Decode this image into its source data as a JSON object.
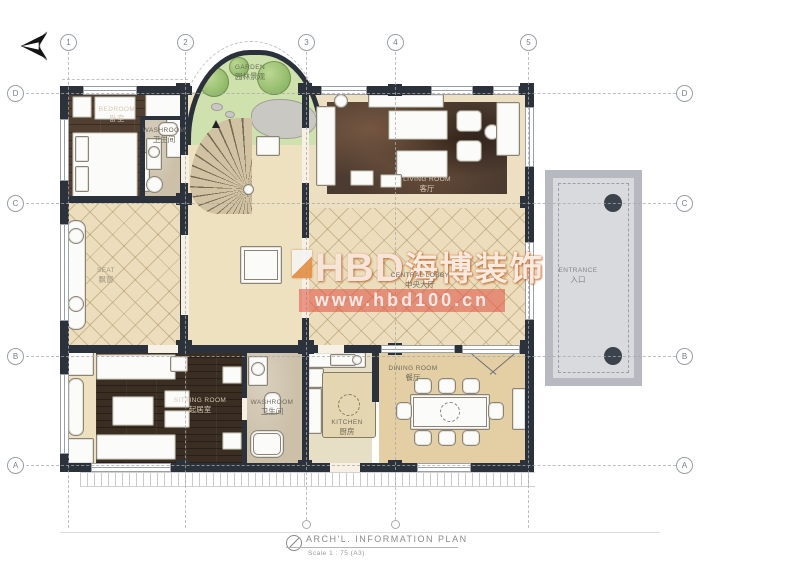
{
  "grid": {
    "columns": [
      "1",
      "2",
      "3",
      "4",
      "5"
    ],
    "rows": [
      "D",
      "C",
      "B",
      "A"
    ]
  },
  "watermark": {
    "logo_text": "HBD",
    "brand": "海博装饰",
    "url": "www.hbd100.cn",
    "band_color": "#e04e40",
    "accent": "#e2892f"
  },
  "rooms": {
    "garden": {
      "en": "GARDEN",
      "zh": "园林景观"
    },
    "bedroom": {
      "en": "BEDROOM",
      "zh": "卧室"
    },
    "washroom_top": {
      "en": "WASHROOM",
      "zh": "卫生间"
    },
    "living": {
      "en": "LIVING ROOM",
      "zh": "客厅"
    },
    "central": {
      "en": "CENTRAL LOBBY",
      "zh": "中央大厅"
    },
    "entrance": {
      "en": "ENTRANCE",
      "zh": "入口"
    },
    "sitting": {
      "en": "SITTING ROOM",
      "zh": "起居室"
    },
    "washroom_bottom": {
      "en": "WASHROOM",
      "zh": "卫生间"
    },
    "kitchen": {
      "en": "KITCHEN",
      "zh": "厨房"
    },
    "dining": {
      "en": "DINING ROOM",
      "zh": "餐厅"
    },
    "window_seat": {
      "en": "SEAT",
      "zh": "飘窗"
    }
  },
  "title_block": {
    "title": "ARCH'L. INFORMATION PLAN",
    "scale": "Scale  1 : 75  (A3)"
  }
}
